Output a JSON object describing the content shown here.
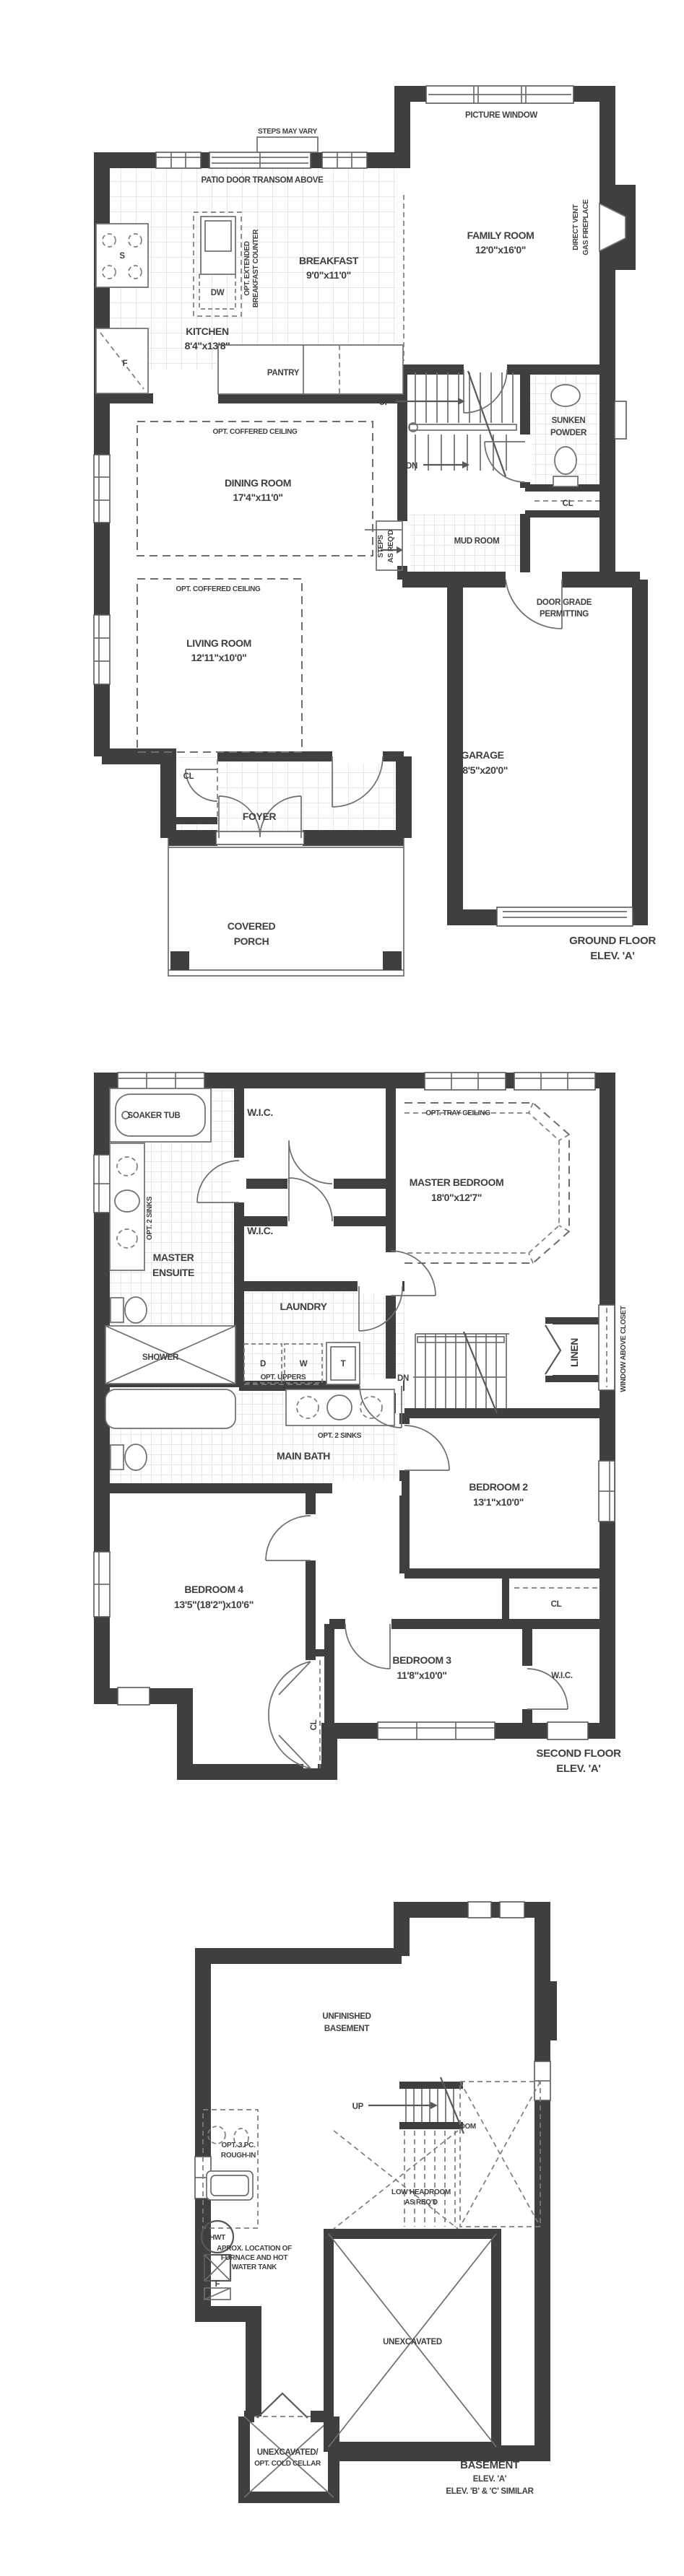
{
  "colors": {
    "wall": "#3f3f3f",
    "thin_line": "#6e6e6e",
    "tile_line": "#d2d2d2",
    "dashed_line": "#7e7e7e",
    "background": "#ffffff"
  },
  "ground_floor": {
    "caption_line1": "GROUND FLOOR",
    "caption_line2": "ELEV. 'A'",
    "labels": {
      "steps_may_vary": "STEPS MAY VARY",
      "patio_door": "PATIO DOOR TRANSOM ABOVE",
      "picture_window": "PICTURE WINDOW",
      "family_room": "FAMILY ROOM",
      "family_room_dim": "12'0\"x16'0\"",
      "fireplace_line1": "DIRECT VENT",
      "fireplace_line2": "GAS FIREPLACE",
      "breakfast": "BREAKFAST",
      "breakfast_dim": "9'0\"x11'0\"",
      "breakfast_counter_line1": "OPT. EXTENDED",
      "breakfast_counter_line2": "BREAKFAST COUNTER",
      "kitchen": "KITCHEN",
      "kitchen_dim": "8'4\"x13'8\"",
      "dishwasher": "DW",
      "sink": "S",
      "fridge": "F",
      "pantry": "PANTRY",
      "stairs_up": "UP",
      "stairs_dn": "DN",
      "powder_line1": "SUNKEN",
      "powder_line2": "POWDER",
      "powder_closet": "CL",
      "mud_room": "MUD ROOM",
      "steps_req_line1": "STEPS",
      "steps_req_line2": "AS REQ'D",
      "dining_opt": "OPT. COFFERED CEILING",
      "dining": "DINING ROOM",
      "dining_dim": "17'4\"x11'0\"",
      "living_opt": "OPT. COFFERED CEILING",
      "living": "LIVING ROOM",
      "living_dim": "12'11\"x10'0\"",
      "door_grade_line1": "DOOR GRADE",
      "door_grade_line2": "PERMITTING",
      "garage": "GARAGE",
      "garage_dim": "18'5\"x20'0\"",
      "foyer": "FOYER",
      "foyer_closet": "CL",
      "porch_line1": "COVERED",
      "porch_line2": "PORCH"
    }
  },
  "second_floor": {
    "caption_line1": "SECOND FLOOR",
    "caption_line2": "ELEV. 'A'",
    "labels": {
      "soaker_tub": "SOAKER TUB",
      "wic_master1": "W.I.C.",
      "wic_master2": "W.I.C.",
      "opt_tray": "OPT. TRAY CEILING",
      "master_bedroom": "MASTER BEDROOM",
      "master_bedroom_dim": "18'0\"x12'7\"",
      "opt_2_sinks_ensuite": "OPT. 2 SINKS",
      "master_ensuite_line1": "MASTER",
      "master_ensuite_line2": "ENSUITE",
      "laundry": "LAUNDRY",
      "shower": "SHOWER",
      "dryer": "D",
      "washer": "W",
      "tub_t": "T",
      "opt_uppers": "OPT. UPPERS",
      "stairs_dn": "DN",
      "linen": "LINEN",
      "window_above_closet": "WINDOW ABOVE CLOSET",
      "opt_2_sinks_bath": "OPT. 2 SINKS",
      "main_bath": "MAIN BATH",
      "bedroom2": "BEDROOM 2",
      "bedroom2_dim": "13'1\"x10'0\"",
      "bedroom4": "BEDROOM 4",
      "bedroom4_dim": "13'5\"(18'2\")x10'6\"",
      "hall_closet": "CL",
      "bedroom3": "BEDROOM 3",
      "bedroom3_dim": "11'8\"x10'0\"",
      "bedroom2_closet": "CL",
      "wic_bedroom3": "W.I.C."
    }
  },
  "basement": {
    "caption_line1": "BASEMENT",
    "caption_line2": "ELEV. 'A'",
    "caption_line3": "ELEV. 'B' & 'C' SIMILAR",
    "labels": {
      "unfinished_line1": "UNFINISHED",
      "unfinished_line2": "BASEMENT",
      "stairs_up": "UP",
      "low_headroom": "LOW HEADROOM",
      "low_headroom_req_line1": "LOW HEADROOM",
      "low_headroom_req_line2": "AS REQ'D",
      "opt_3pc_line1": "OPT. 3 PC.",
      "opt_3pc_line2": "ROUGH-IN",
      "hwt": "HWT",
      "furnace_line1": "APROX. LOCATION OF",
      "furnace_line2": "FURNACE AND HOT",
      "furnace_line3": "WATER TANK",
      "furnace_f": "F",
      "unexcavated": "UNEXCAVATED",
      "cold_cellar_line1": "UNEXCAVATED/",
      "cold_cellar_line2": "OPT. COLD CELLAR"
    }
  }
}
